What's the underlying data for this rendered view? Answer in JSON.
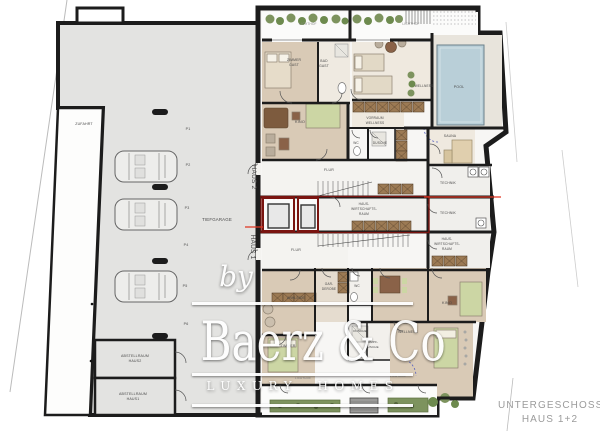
{
  "plan_title": {
    "line1": "UNTERGESCHOSS",
    "line2": "HAUS 1+2"
  },
  "watermark": {
    "by": "by",
    "brand": "Baerz & Co",
    "tagline": "LUXURY HOMES"
  },
  "garage": {
    "name": "TIEFGARAGE",
    "driveway": "ZUFAHRT",
    "spaces": [
      "P1",
      "P2",
      "P3",
      "P4",
      "P5",
      "P6"
    ],
    "storage_rooms": [
      [
        "ABSTELLRAUM",
        "HAUS2"
      ],
      [
        "ABSTELLRAUM",
        "HAUS1"
      ]
    ]
  },
  "house_markers": {
    "haus2": "HAUS 2",
    "haus1": "HAUS 1"
  },
  "haus2_rooms": {
    "lichthof_left": "LICHTHOF",
    "lichthof_right": "LICHTHOF",
    "zimmer_gast": [
      "ZIMMER",
      "GAST"
    ],
    "bad_gast": [
      "BAD",
      "GAST"
    ],
    "wellness": "WELLNESS",
    "pool": "POOL",
    "sauna": "SAUNA",
    "kino": "KINO",
    "vorraum_wellness": [
      "VORRAUM",
      "WELLNESS"
    ],
    "wc": "WC",
    "dusche": "DUSCHE",
    "flur": "FLUR",
    "technik": "TECHNIK"
  },
  "shared_rooms": {
    "hauswirtschaftsraum": [
      "HAUS-",
      "WIRTSCHAFTS-",
      "RAUM"
    ]
  },
  "haus1_rooms": {
    "technik": "TECHNIK",
    "hauswirtschaftsraum": [
      "HAUS-",
      "WIRTSCHAFTS-",
      "RAUM"
    ],
    "flur": "FLUR",
    "garderobe": [
      "GAR-",
      "DEROBE"
    ],
    "wc": "WC",
    "ankleide": "ANKLEIDE",
    "kino": "KINO",
    "wellness": "WELLNESS",
    "dusche": "DUSCHE",
    "dampfdusche": [
      "DAMPF-",
      "DUSCHE"
    ],
    "zimmer": "ZIMMER",
    "lichthof_left": "LICHTHOF",
    "lichthof_right": "LICHTHOF"
  },
  "colors": {
    "wall": "#1c1c1c",
    "garage_floor": "#e3e3e1",
    "room_tan": "#d9cab6",
    "pool_water": "#b9cfd8",
    "plant_green": "#7d935e",
    "bed_green": "#ccd6a4",
    "cabinet_brown": "#9c7a54",
    "section_red": "#e03522",
    "shared_outline_red": "#7a1410"
  }
}
